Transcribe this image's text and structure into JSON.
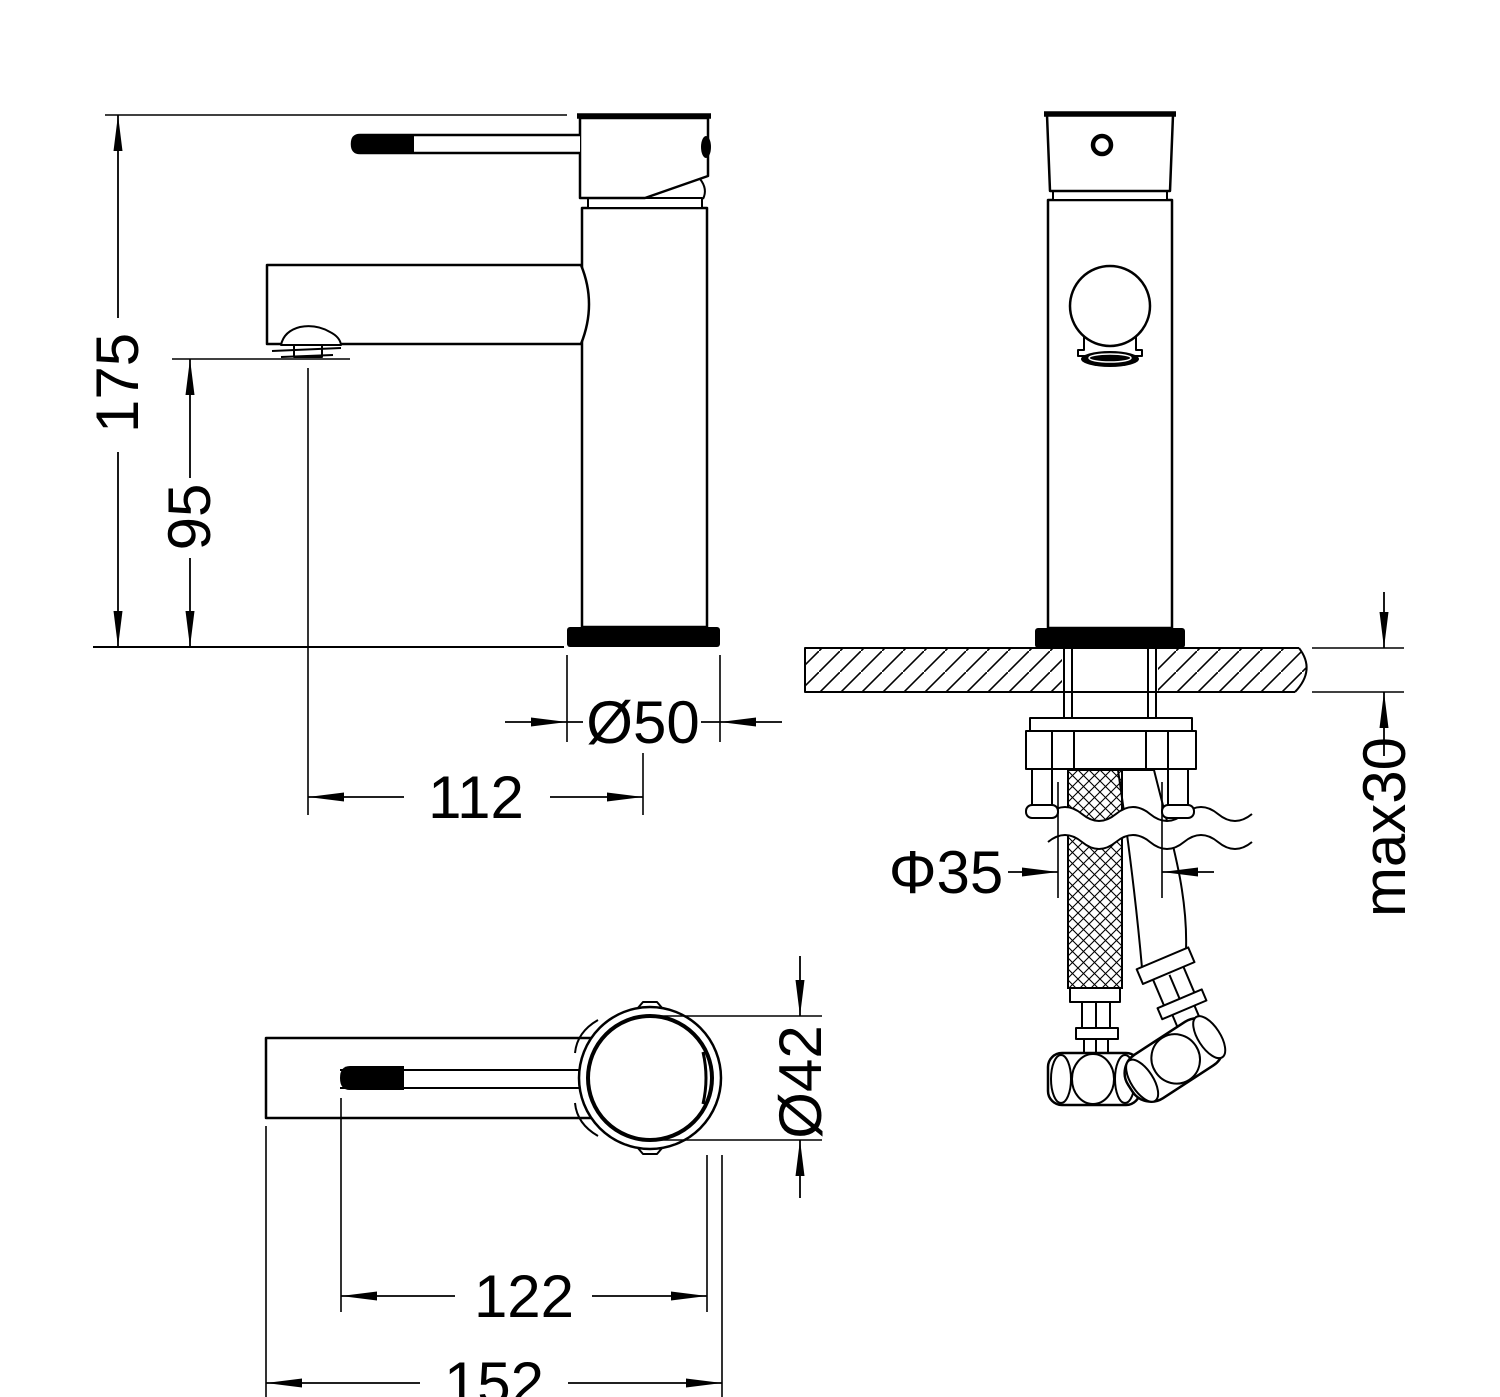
{
  "drawing": {
    "type": "technical-dimension-drawing",
    "subject": "single-lever basin mixer faucet",
    "background_color": "#ffffff",
    "line_color": "#000000",
    "views": [
      {
        "id": "side-view",
        "description": "side elevation with handle, spout and base on mounting line"
      },
      {
        "id": "front-view",
        "description": "front elevation mounted through counter with supply hoses"
      },
      {
        "id": "top-view",
        "description": "plan view of lever handle and body"
      }
    ]
  },
  "dimensions": {
    "total_height": "175",
    "spout_height": "95",
    "base_diameter": "Ø50",
    "spout_reach": "112",
    "max_deck_thickness": "max30",
    "mount_hole_diameter": "Φ35",
    "body_diameter": "Ø42",
    "handle_reach": "122",
    "overall_length": "152"
  }
}
